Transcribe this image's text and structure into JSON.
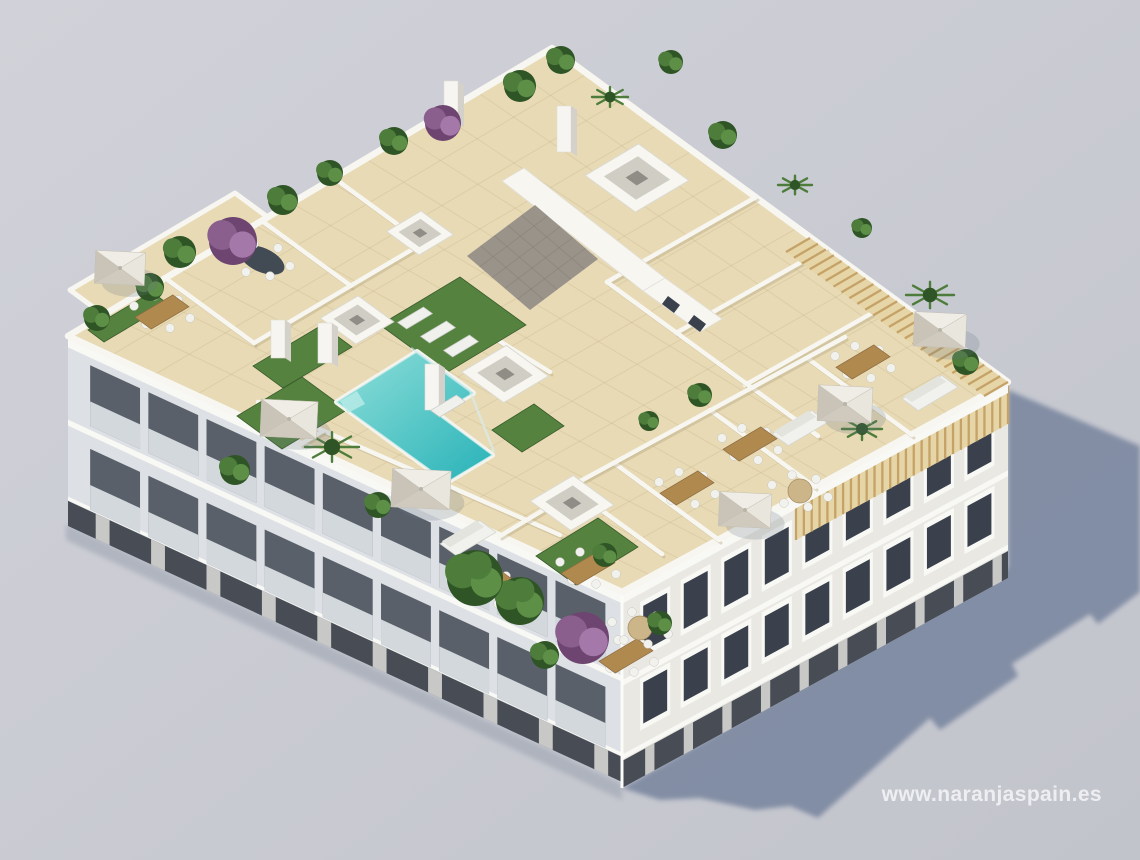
{
  "image": {
    "type": "3d-architectural-render",
    "subject": "Aerial view of a white apartment building with rooftop terraces, swimming pool, parasols and plants",
    "features": [
      "rooftop pool",
      "artificial grass",
      "sun parasols",
      "private terraces with dining tables",
      "stairwell with tiled hip roof",
      "skylight openings",
      "wooden pergola slats",
      "balconied facades",
      "cast shadow on ground"
    ]
  },
  "watermark": {
    "text": "www.naranjaspain.es"
  },
  "palette": {
    "bg_top": "#d1d2d9",
    "bg_bottom": "#c2c4cc",
    "shadow": "#7e8aa2",
    "ground_contact": "#9aa2af",
    "facade_left": "#dde0e4",
    "facade_right": "#eae8e2",
    "trim": "#f8f8f5",
    "glass": "#3a414c",
    "base_dark": "#474c55",
    "roof_tile": "#e7dab5",
    "tile_line": "#b79d6e",
    "parapet": "#f7f6f1",
    "wall_shadow": "#b7a87f",
    "pool_light": "#8fdfd9",
    "pool_deep": "#28b2b8",
    "pool_coping": "#f4f3ee",
    "grass": "#55833f",
    "grass_dark": "#3a5c2d",
    "stair_roof": "#9a938a",
    "pergola_base": "#e6d5a7",
    "pergola_stripe": "#c5a267",
    "parasol_light": "#f0ede6",
    "parasol_dark": "#cfc9be",
    "wood": "#b0894f",
    "furniture": "#f1f1ee",
    "plant": "#4d7c3b",
    "plant_dark": "#2f5526",
    "plant_purple": "#8a5f8e"
  }
}
